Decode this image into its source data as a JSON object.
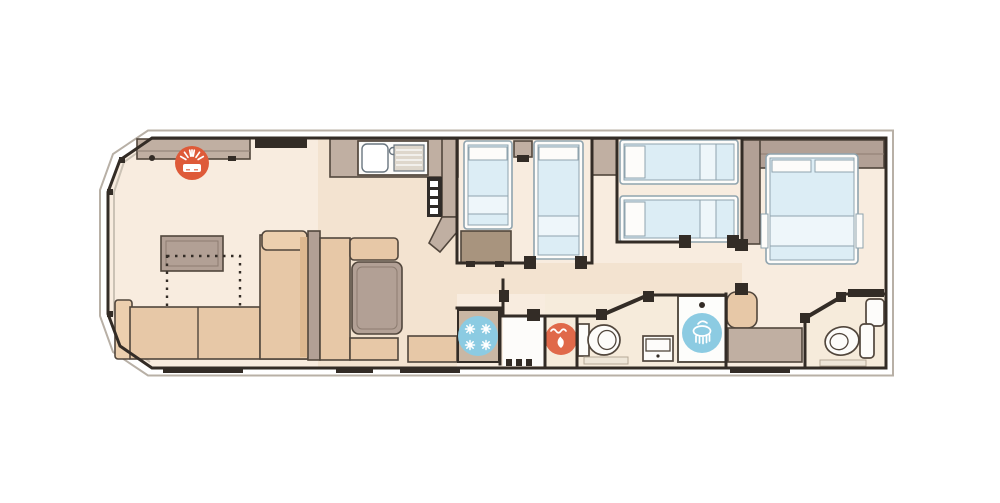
{
  "plan": {
    "type": "static-caravan-floorplan",
    "icons": [
      {
        "name": "electric-fire-icon",
        "color": "#de5a39"
      },
      {
        "name": "fridge-freezer-icon",
        "color": "#8ccbe2"
      },
      {
        "name": "boiler-icon",
        "color": "#e0694a"
      },
      {
        "name": "shower-icon",
        "color": "#8ccbe2"
      }
    ]
  },
  "colors": {
    "wall": "#332c26",
    "outline": "#b8b0a6",
    "floor": "#f8ecdf",
    "floor2": "#f3e3d0",
    "floorWet": "#f6ebdb",
    "white": "#fdfcfa",
    "tan": "#e7c8a7",
    "tanLight": "#eccfae",
    "taupe": "#b2a095",
    "taupeLight": "#c0afa2",
    "wood": "#a8947e",
    "mattress": "#dcedf5",
    "mattressBand": "#eef6fa",
    "bedStroke": "#8fa3ae",
    "red": "#de5a39",
    "blue": "#8ccbe2",
    "flameOrange": "#e0694a",
    "furnStroke": "#51463c"
  }
}
